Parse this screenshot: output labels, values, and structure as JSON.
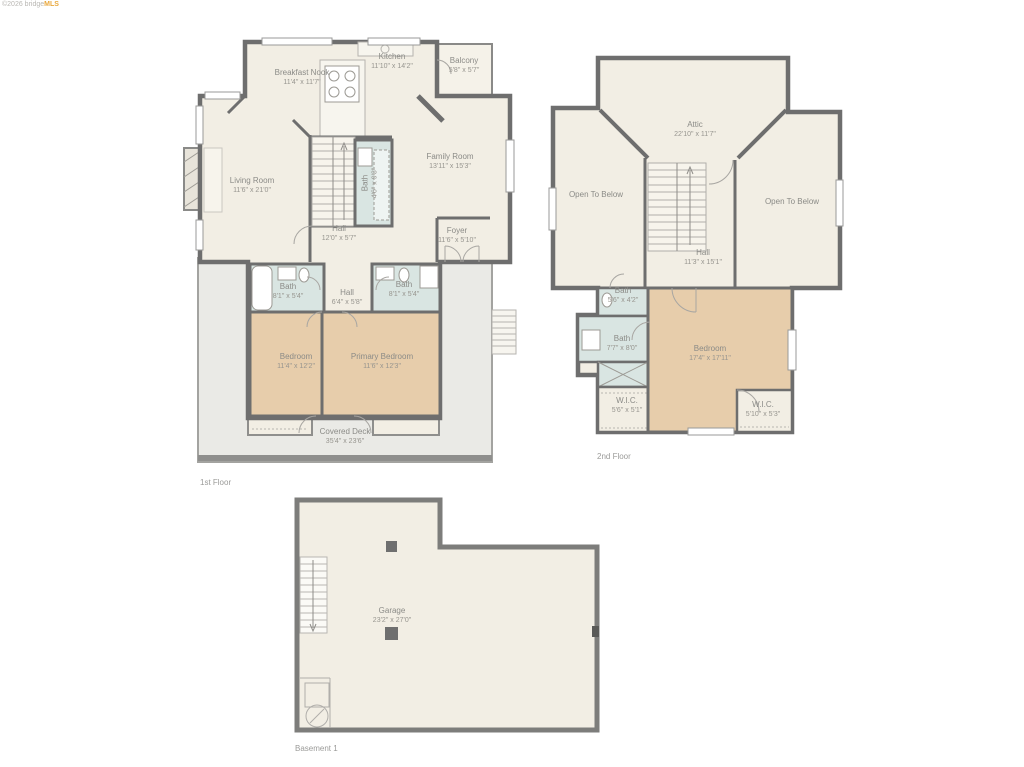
{
  "watermark": {
    "prefix": "©2026 bridge",
    "brand": "MLS"
  },
  "colors": {
    "wall": "#6e6e6e",
    "floor": "#f2eee4",
    "bedroom": "#e7cdab",
    "bath": "#d9e5e2",
    "deck": "#eaeae6",
    "label": "#8b8b87",
    "brand_orange": "#e9a83c"
  },
  "floors": {
    "first": {
      "title": "1st Floor",
      "rooms": {
        "breakfast_nook": {
          "name": "Breakfast Nook",
          "dims": "11'4\" x 11'7\""
        },
        "kitchen": {
          "name": "Kitchen",
          "dims": "11'10\" x 14'2\""
        },
        "balcony": {
          "name": "Balcony",
          "dims": "5'8\" x 5'7\""
        },
        "living_room": {
          "name": "Living Room",
          "dims": "11'6\" x 21'0\""
        },
        "family_room": {
          "name": "Family Room",
          "dims": "13'11\" x 15'3\""
        },
        "bath_center": {
          "name": "Bath",
          "dims": "4'6\" x 9'3\""
        },
        "hall": {
          "name": "Hall",
          "dims": "12'0\" x 5'7\""
        },
        "foyer": {
          "name": "Foyer",
          "dims": "11'6\" x 5'10\""
        },
        "bath_left": {
          "name": "Bath",
          "dims": "8'1\" x 5'4\""
        },
        "hall_lower": {
          "name": "Hall",
          "dims": "6'4\" x 5'8\""
        },
        "bath_right": {
          "name": "Bath",
          "dims": "8'1\" x 5'4\""
        },
        "bedroom": {
          "name": "Bedroom",
          "dims": "11'4\" x 12'2\""
        },
        "primary_bedroom": {
          "name": "Primary Bedroom",
          "dims": "11'6\" x 12'3\""
        },
        "covered_deck": {
          "name": "Covered Deck",
          "dims": "35'4\" x 23'6\""
        }
      }
    },
    "second": {
      "title": "2nd Floor",
      "rooms": {
        "attic": {
          "name": "Attic",
          "dims": "22'10\" x 11'7\""
        },
        "open_left": {
          "name": "Open To Below",
          "dims": ""
        },
        "open_right": {
          "name": "Open To Below",
          "dims": ""
        },
        "hall": {
          "name": "Hall",
          "dims": "11'3\" x 15'1\""
        },
        "bath_small": {
          "name": "Bath",
          "dims": "5'6\" x 4'2\""
        },
        "bath_mid": {
          "name": "Bath",
          "dims": "7'7\" x 8'0\""
        },
        "bedroom": {
          "name": "Bedroom",
          "dims": "17'4\" x 17'11\""
        },
        "wic_left": {
          "name": "W.I.C.",
          "dims": "5'6\" x 5'1\""
        },
        "wic_right": {
          "name": "W.I.C.",
          "dims": "5'10\" x 5'3\""
        }
      }
    },
    "basement": {
      "title": "Basement 1",
      "rooms": {
        "garage": {
          "name": "Garage",
          "dims": "23'2\" x 27'0\""
        }
      }
    }
  }
}
